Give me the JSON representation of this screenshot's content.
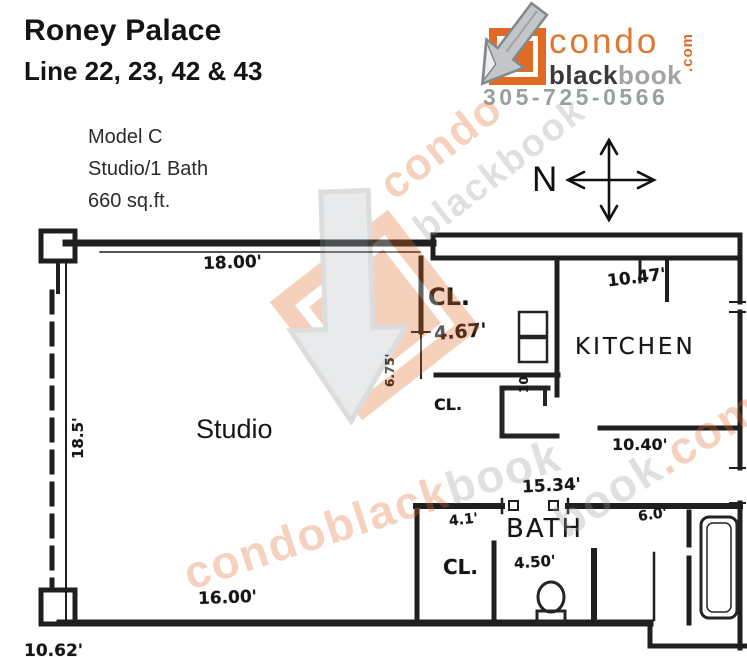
{
  "header": {
    "title": "Roney Palace",
    "subtitle": "Line 22, 23, 42 & 43"
  },
  "brand": {
    "word_condo": "condo",
    "word_black": "black",
    "word_book": "book",
    "word_tld": ".com",
    "phone": "305-725-0566",
    "orange": "#e06a24",
    "gray": "#9aa0a2"
  },
  "unit": {
    "model": "Model C",
    "type": "Studio/1 Bath",
    "area": "660 sq.ft."
  },
  "compass": {
    "north": "N"
  },
  "plan": {
    "rooms": {
      "studio": "Studio",
      "kitchen": "KITCHEN",
      "bath": "BATH",
      "closet_upper": "CL.",
      "closet_hall": "CL.",
      "closet_bath": "CL."
    },
    "dims": {
      "studio_top": "18.00'",
      "kitchen_top": "10.47'",
      "closet_width": "4.67'",
      "closet_depth": "6.75'",
      "kitchen_width": "10.40'",
      "bath_span": "15.34'",
      "bath_closet": "4.1'",
      "bath_right": "6.0'",
      "bath_core": "4.50'",
      "studio_left": "18.5'",
      "studio_bottom": "16.00'",
      "entry_bottom": "10.62'",
      "kitchen_entry": "10"
    }
  },
  "watermark": {
    "condo": "condo",
    "black": "black",
    "book": "book",
    "tld": ".com"
  }
}
